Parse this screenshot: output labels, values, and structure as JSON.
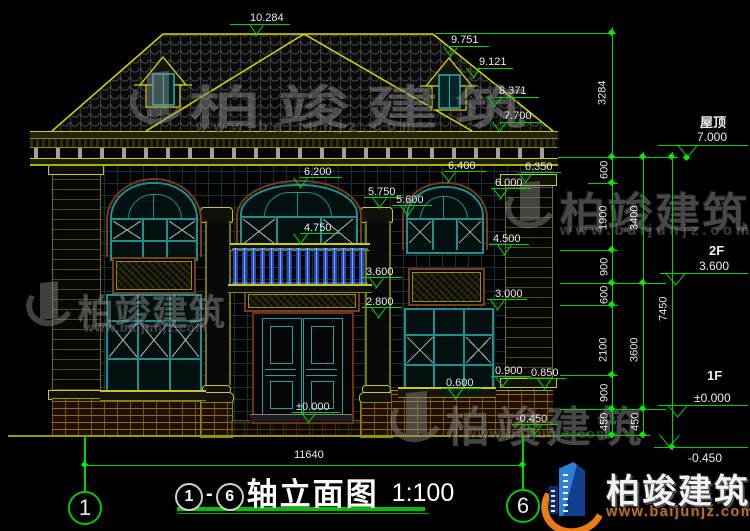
{
  "brand": {
    "name": "柏竣建筑",
    "url": "www.baijunjz.com"
  },
  "drawing": {
    "title": "轴立面图",
    "scale": "1:100",
    "dash": "-",
    "axis_start": "1",
    "axis_end": "6",
    "total_width": "11640"
  },
  "levels": {
    "roof_label": "屋顶",
    "roof": "7.000",
    "f2_label": "2F",
    "f2": "3.600",
    "f1_label": "1F",
    "f1": "±0.000",
    "ground": "-0.450"
  },
  "elev": {
    "peak": "10.284",
    "dormer_top": "9.751",
    "dormer_eave": "9.121",
    "roof_edge": "8.371",
    "eave": "7.700",
    "cwin_top": "6.200",
    "cap_l": "5.750",
    "cap_r": "5.600",
    "rwin_top": "6.400",
    "corner_cap": "6.350",
    "rspring": "6.000",
    "rail": "4.750",
    "rwin_sill": "4.500",
    "balcony": "3.600",
    "door_top": "2.800",
    "fwin_top": "3.000",
    "pier": "0.900",
    "corner_base": "0.850",
    "fwin_sill": "0.600",
    "floor1": "±0.000",
    "ground": "-0.450"
  },
  "chain1": [
    "3284",
    "600",
    "1900",
    "900",
    "600",
    "2100",
    "900",
    "450"
  ],
  "chain2": [
    "3400",
    "3600",
    "450"
  ],
  "chain3": [
    "7450"
  ]
}
